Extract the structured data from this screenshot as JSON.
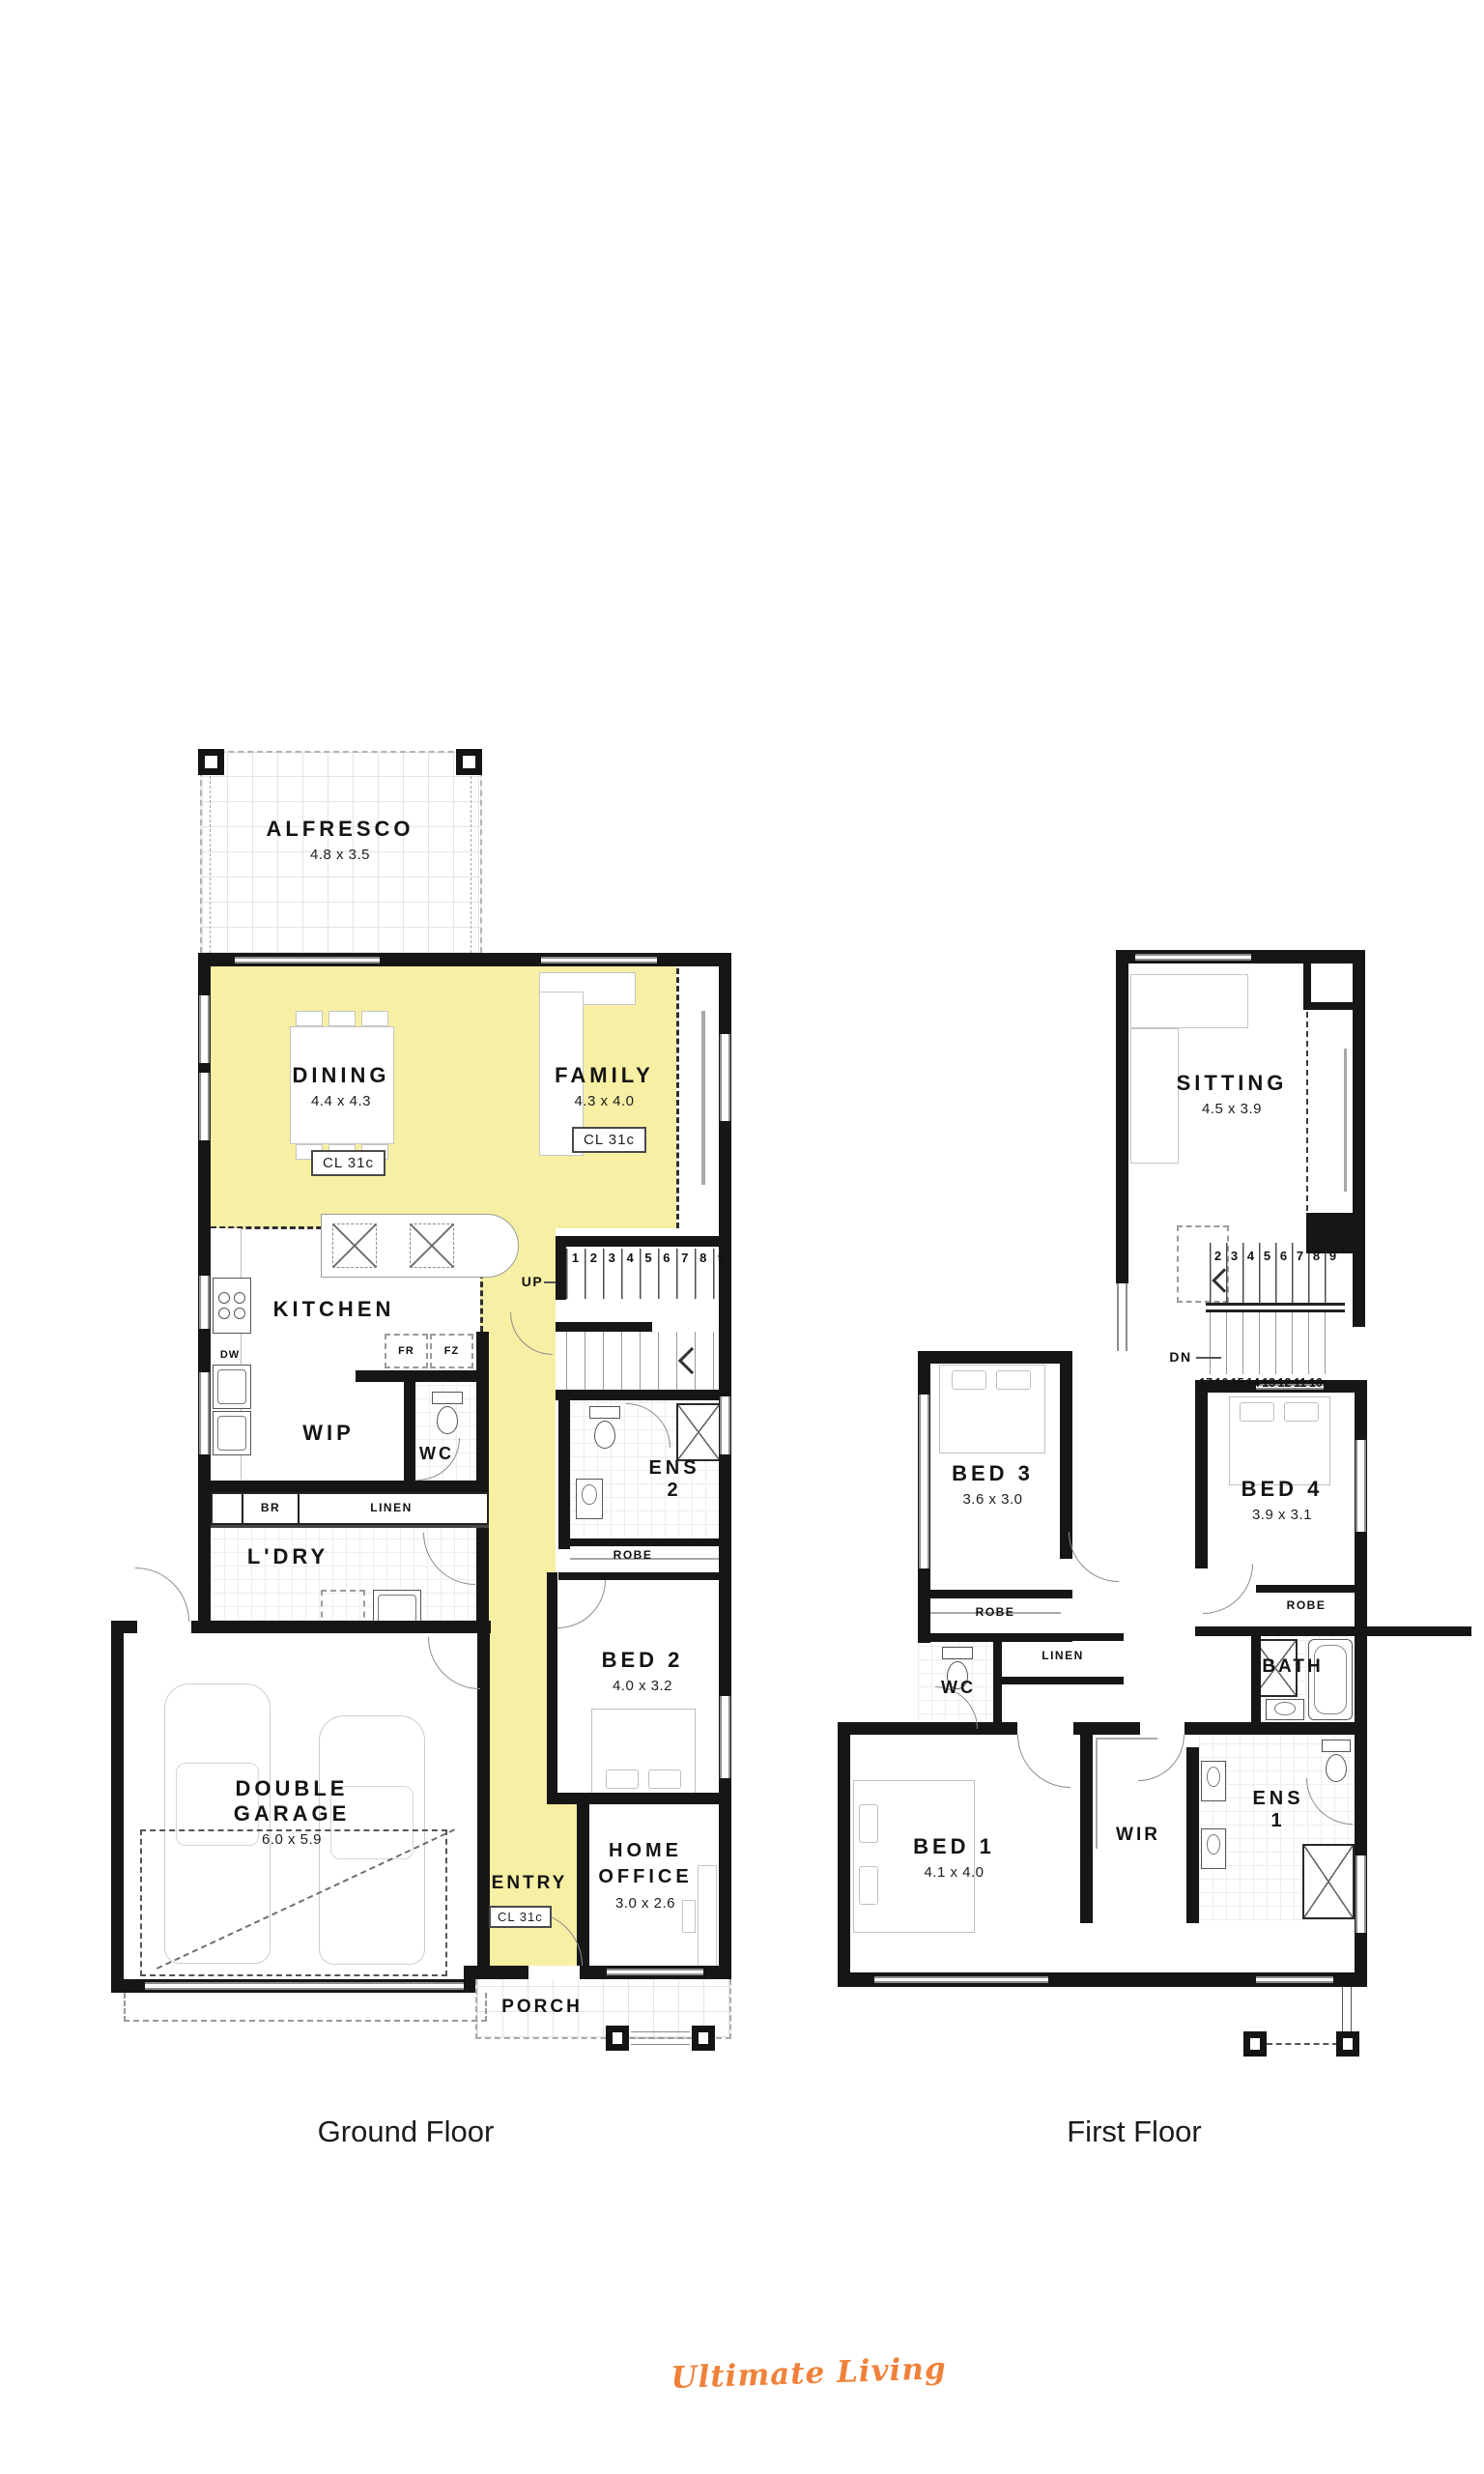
{
  "brand": {
    "logo_text": "Ultimate Living",
    "logo_color": "#F0813A"
  },
  "palette": {
    "highlight_yellow": "#F6EFA4",
    "wall_black": "#161616"
  },
  "ground_floor": {
    "caption": "Ground Floor",
    "stairs": {
      "up_label": "UP",
      "steps": [
        "1",
        "2",
        "3",
        "4",
        "5",
        "6",
        "7",
        "8",
        "9"
      ]
    },
    "rooms": {
      "alfresco": {
        "name": "ALFRESCO",
        "dims": "4.8 x 3.5"
      },
      "dining": {
        "name": "DINING",
        "dims": "4.4 x 4.3",
        "ceiling": "CL 31c"
      },
      "family": {
        "name": "FAMILY",
        "dims": "4.3 x 4.0",
        "ceiling": "CL 31c"
      },
      "kitchen": {
        "name": "KITCHEN"
      },
      "wip": {
        "name": "WIP"
      },
      "wc": {
        "name": "WC"
      },
      "ens2": {
        "name": "ENS",
        "number": "2"
      },
      "robe": {
        "name": "ROBE"
      },
      "bed2": {
        "name": "BED 2",
        "dims": "4.0 x 3.2"
      },
      "ldry": {
        "name": "L'DRY"
      },
      "br": {
        "name": "BR"
      },
      "linen": {
        "name": "LINEN"
      },
      "garage": {
        "name": "DOUBLE GARAGE",
        "dims": "6.0 x 5.9"
      },
      "entry": {
        "name": "ENTRY",
        "ceiling": "CL 31c"
      },
      "home_office": {
        "name": "HOME OFFICE",
        "dims": "3.0 x 2.6"
      },
      "porch": {
        "name": "PORCH"
      }
    },
    "appliances": {
      "dw": "DW",
      "fr": "FR",
      "fz": "FZ"
    }
  },
  "first_floor": {
    "caption": "First Floor",
    "stairs": {
      "dn_label": "DN",
      "steps_up": [
        "2",
        "3",
        "4",
        "5",
        "6",
        "7",
        "8",
        "9"
      ],
      "steps_down": [
        "17",
        "16",
        "15",
        "14",
        "13",
        "12",
        "11",
        "10"
      ]
    },
    "rooms": {
      "sitting": {
        "name": "SITTING",
        "dims": "4.5 x 3.9"
      },
      "bed3": {
        "name": "BED 3",
        "dims": "3.6 x 3.0"
      },
      "bed4": {
        "name": "BED 4",
        "dims": "3.9 x 3.1"
      },
      "robe_bed3": {
        "name": "ROBE"
      },
      "robe_bed4": {
        "name": "ROBE"
      },
      "wc": {
        "name": "WC"
      },
      "linen": {
        "name": "LINEN"
      },
      "bath": {
        "name": "BATH"
      },
      "bed1": {
        "name": "BED 1",
        "dims": "4.1 x 4.0"
      },
      "wir": {
        "name": "WIR"
      },
      "ens1": {
        "name": "ENS",
        "number": "1"
      }
    }
  }
}
